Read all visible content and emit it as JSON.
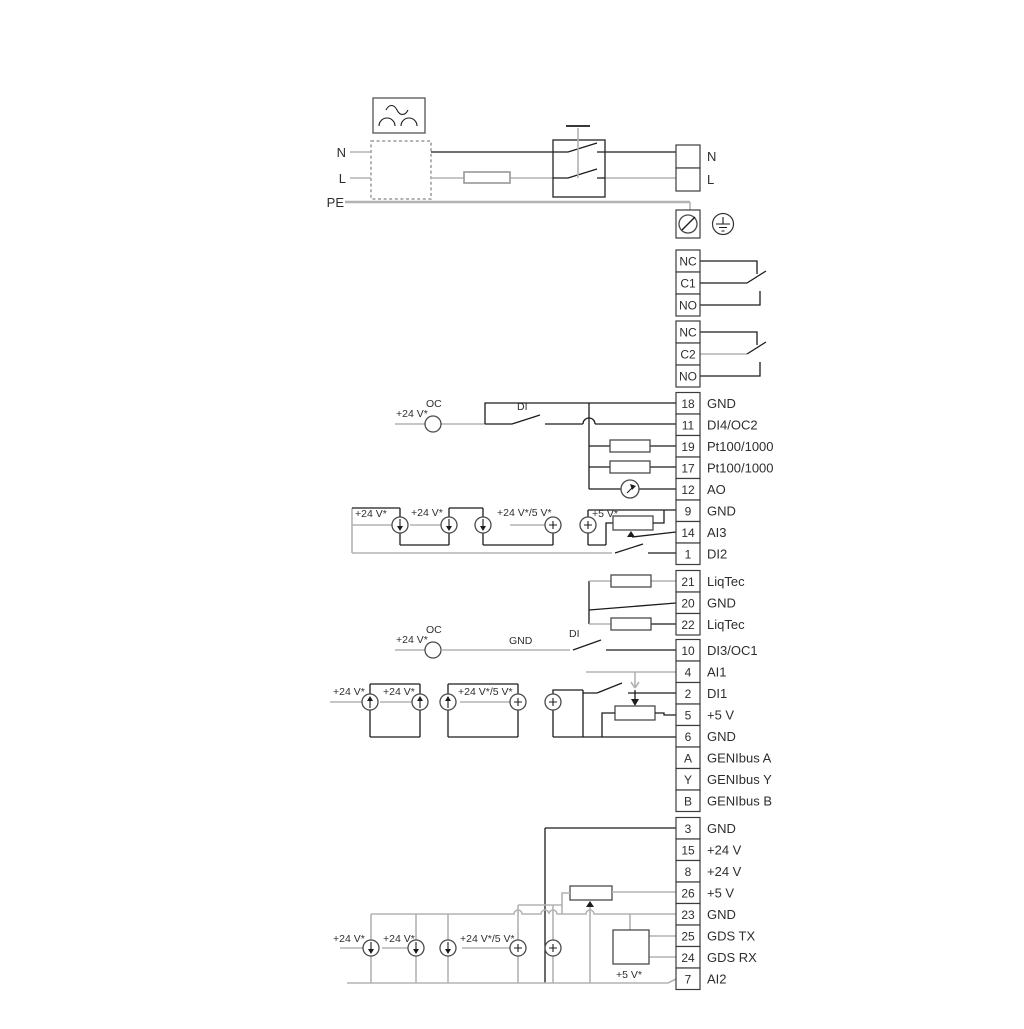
{
  "labels": {
    "n": "N",
    "l": "L",
    "pe": "PE",
    "v24": "+24 V*",
    "v24v5": "+24 V*/5 V*",
    "v5": "+5 V*",
    "oc": "OC",
    "di": "DI",
    "gnd": "GND"
  },
  "strips": {
    "power": {
      "terminals": [
        [
          "",
          "N"
        ],
        [
          "",
          "L"
        ]
      ]
    },
    "relay1": {
      "terminals": [
        [
          "NC",
          ""
        ],
        [
          "C1",
          ""
        ],
        [
          "NO",
          ""
        ]
      ]
    },
    "relay2": {
      "terminals": [
        [
          "NC",
          ""
        ],
        [
          "C2",
          ""
        ],
        [
          "NO",
          ""
        ]
      ]
    },
    "io1": {
      "terminals": [
        [
          "18",
          "GND"
        ],
        [
          "11",
          "DI4/OC2"
        ],
        [
          "19",
          "Pt100/1000"
        ],
        [
          "17",
          "Pt100/1000"
        ],
        [
          "12",
          "AO"
        ],
        [
          "9",
          "GND"
        ],
        [
          "14",
          "AI3"
        ],
        [
          "1",
          "DI2"
        ]
      ]
    },
    "liqtec": {
      "terminals": [
        [
          "21",
          "LiqTec"
        ],
        [
          "20",
          "GND"
        ],
        [
          "22",
          "LiqTec"
        ]
      ]
    },
    "io2": {
      "terminals": [
        [
          "10",
          "DI3/OC1"
        ],
        [
          "4",
          "AI1"
        ],
        [
          "2",
          "DI1"
        ],
        [
          "5",
          "+5 V"
        ],
        [
          "6",
          "GND"
        ],
        [
          "A",
          "GENIbus A"
        ],
        [
          "Y",
          "GENIbus Y"
        ],
        [
          "B",
          "GENIbus B"
        ]
      ]
    },
    "io3": {
      "terminals": [
        [
          "3",
          "GND"
        ],
        [
          "15",
          "+24 V"
        ],
        [
          "8",
          "+24 V"
        ],
        [
          "26",
          "+5 V"
        ],
        [
          "23",
          "GND"
        ],
        [
          "25",
          "GDS TX"
        ],
        [
          "24",
          "GDS RX"
        ],
        [
          "7",
          "AI2"
        ]
      ]
    }
  },
  "colors": {
    "wire_dark": "#1c1c1c",
    "wire_gray": "#b3b3b3",
    "text": "#2e2e2e",
    "background": "#ffffff"
  }
}
